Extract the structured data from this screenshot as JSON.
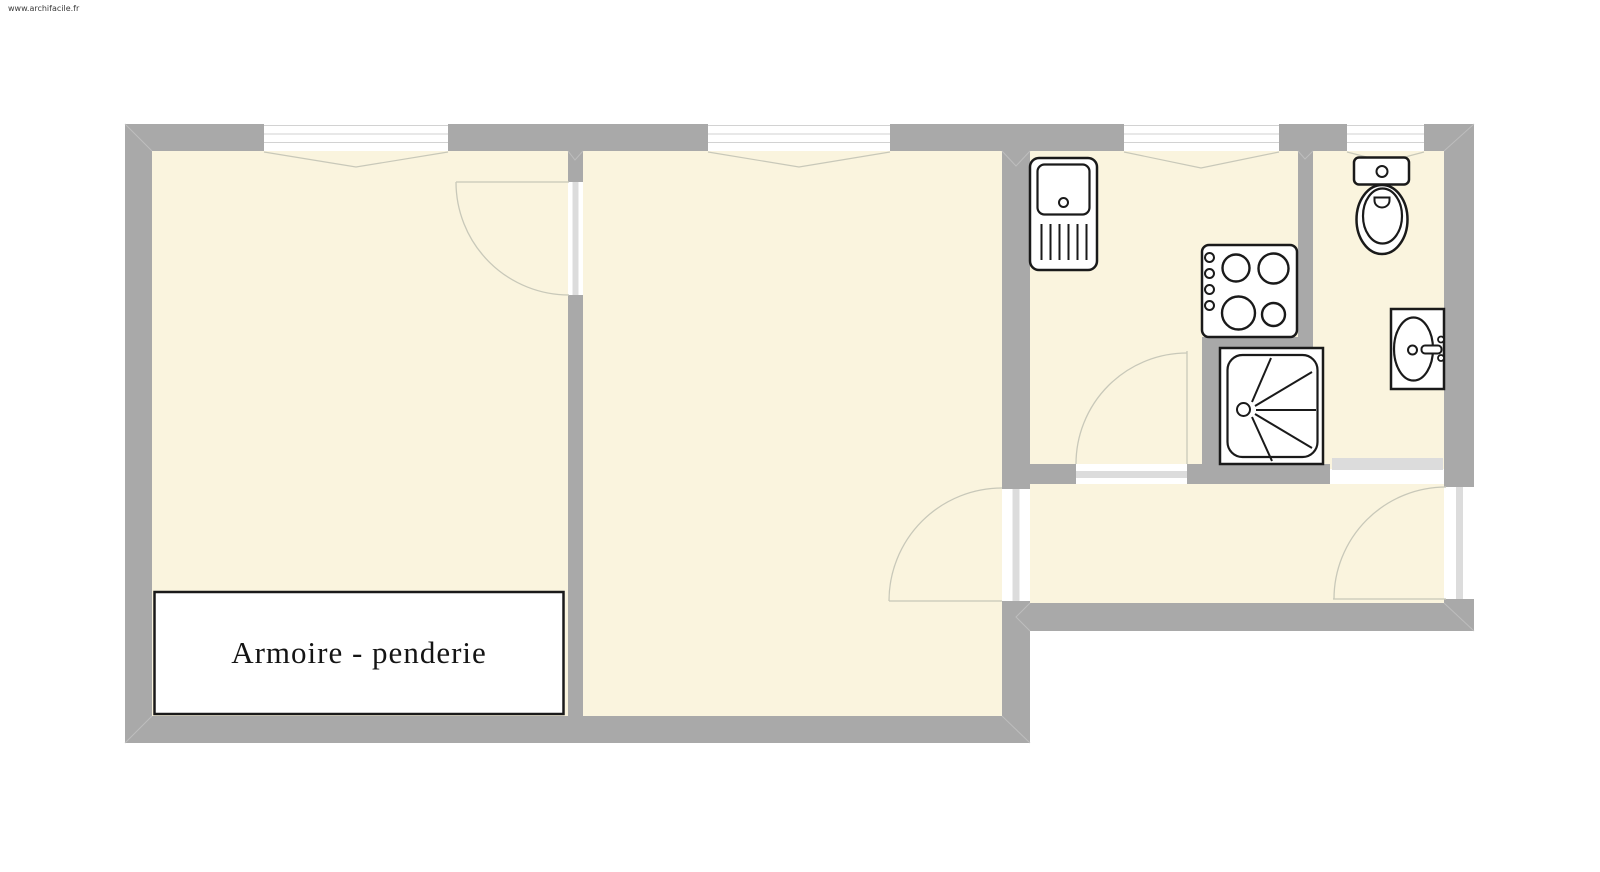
{
  "watermark": {
    "text": "www.archifacile.fr"
  },
  "labels": {
    "closet": "Armoire - penderie"
  },
  "colors": {
    "page": "#ffffff",
    "wall": "#a9a9a9",
    "floor": "#faf4de",
    "doorway_stripe": "#dcdcdc",
    "sliding_leaf": "#dcdcdc",
    "window_line": "#d2d2d2",
    "door_swing": "#c8c8b9",
    "miter": "#bdbdbd",
    "fixture_outline": "#1a1a1a",
    "fixture_fill": "#ffffff"
  },
  "fixtures": {
    "kitchen": [
      "kitchen-sink",
      "stove"
    ],
    "bathroom": [
      "toilet",
      "bathroom-sink",
      "shower"
    ]
  }
}
